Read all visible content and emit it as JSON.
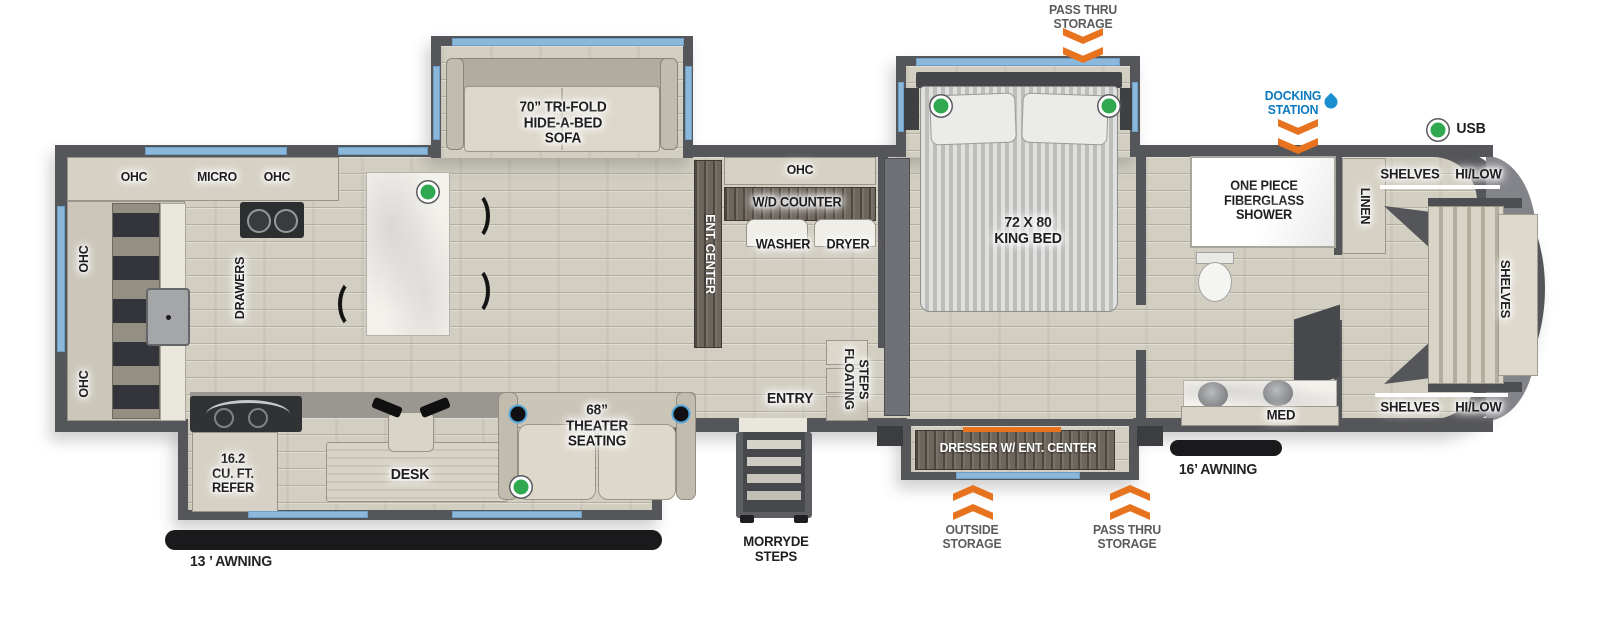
{
  "colors": {
    "wall": "#55565a",
    "window_blue": "#8ab7da",
    "arrow_orange": "#e8731f",
    "docking_blue": "#0c7ac0",
    "usb_green": "#2fa84f",
    "floor_wood": "#d2cec2"
  },
  "exterior": {
    "pass_thru_storage_top": "PASS THRU\nSTORAGE",
    "docking_station": "DOCKING\nSTATION",
    "usb": "USB",
    "outside_storage": "OUTSIDE\nSTORAGE",
    "pass_thru_storage_bottom": "PASS THRU\nSTORAGE",
    "morryde_steps": "MORRYDE\nSTEPS",
    "awning_13": "13 ’ AWNING",
    "awning_16": "16’ AWNING"
  },
  "kitchen": {
    "ohc_top_left": "OHC",
    "micro": "MICRO",
    "ohc_top_right": "OHC",
    "ohc_rear_upper": "OHC",
    "ohc_rear_lower": "OHC",
    "drawers": "DRAWERS",
    "refer": "16.2\nCU. FT.\nREFER"
  },
  "living": {
    "sofa": "70” TRI-FOLD\nHIDE-A-BED\nSOFA",
    "theater_seating": "68”\nTHEATER\nSEATING",
    "desk": "DESK",
    "ent_center": "ENT. CENTER"
  },
  "laundry": {
    "ohc": "OHC",
    "wd_counter": "W/D COUNTER",
    "washer": "WASHER",
    "dryer": "DRYER"
  },
  "entryway": {
    "entry": "ENTRY",
    "floating_steps": "FLOATING\nSTEPS"
  },
  "bedroom": {
    "king_bed": "72 X 80\nKING BED",
    "dresser": "DRESSER W/ ENT. CENTER"
  },
  "bathroom": {
    "shower": "ONE PIECE\nFIBERGLASS\nSHOWER",
    "med": "MED",
    "linen": "LINEN"
  },
  "front_closet": {
    "shelves_hi_low_top": "SHELVES HI/LOW",
    "shelves_hi_low_bottom": "SHELVES HI/LOW",
    "shelves": "SHELVES"
  }
}
